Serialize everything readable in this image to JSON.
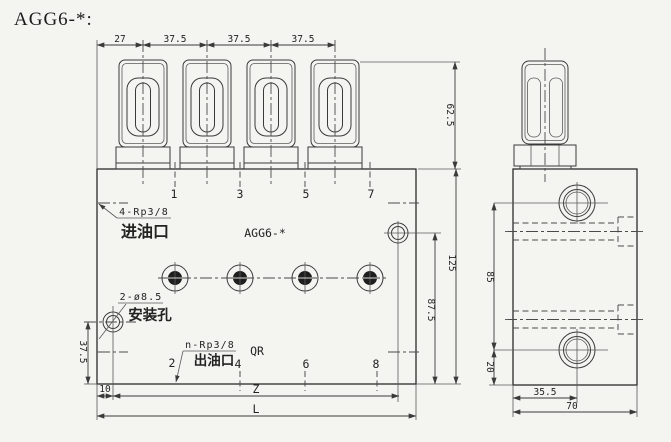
{
  "title": "AGG6-*:",
  "colors": {
    "paper": "#f4f4f1",
    "ink": "#2b2b2b"
  },
  "front": {
    "model_label": "AGG6-*",
    "top_dims": [
      "27",
      "37.5",
      "37.5",
      "37.5"
    ],
    "top_ports": [
      "1",
      "3",
      "5",
      "7"
    ],
    "bottom_ports": [
      "2",
      "4",
      "6",
      "8"
    ],
    "inlet_spec": "4-Rp3/8",
    "inlet_label": "进油口",
    "outlet_spec": "n-Rp3/8",
    "outlet_label": "出油口",
    "outlet_note": "QR",
    "mount_spec": "2-ø8.5",
    "mount_label": "安装孔",
    "dim_valve_height": "62.5",
    "dim_block_height": "125",
    "dim_hole_to_bottom": "87.5",
    "dim_hole_up": "37.5",
    "dim_left_offset": "10",
    "dim_hole_span": "Z",
    "dim_length": "L"
  },
  "side": {
    "dim_port_span": "85",
    "dim_lower_port": "20",
    "dim_port_x": "35.5",
    "dim_width": "70"
  }
}
